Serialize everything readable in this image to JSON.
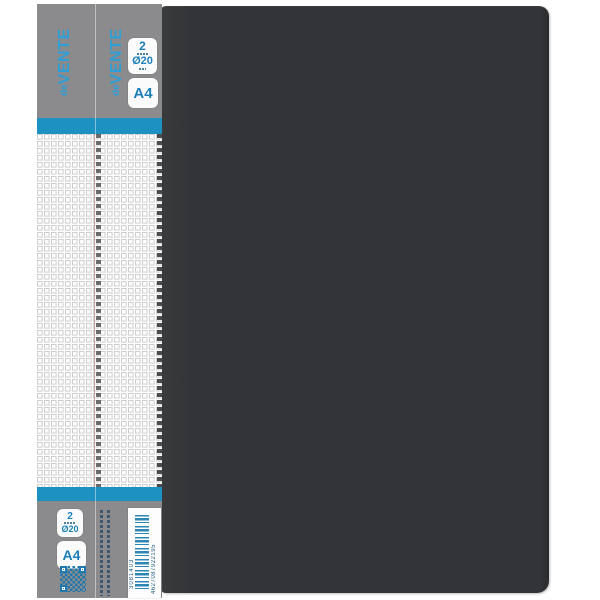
{
  "page": {
    "background": "#ffffff"
  },
  "binder": {
    "cover_color": "#333437"
  },
  "spine_label": {
    "brand": {
      "prefix": "de",
      "name": "VENTE"
    },
    "badges": {
      "rings_count": "2",
      "ring_diameter": "Ø20",
      "format": "A4"
    },
    "barcode": {
      "sku": "3081403",
      "ean": "4627087922195"
    },
    "colors": {
      "label_gray": "#8b8a8c",
      "stripe_blue": "#1e91c3",
      "brand_blue": "#2e9fd6",
      "badge_text_blue": "#1d7fb8",
      "print_blue": "#2079ae",
      "grid_line": "#cfcfcf"
    }
  }
}
